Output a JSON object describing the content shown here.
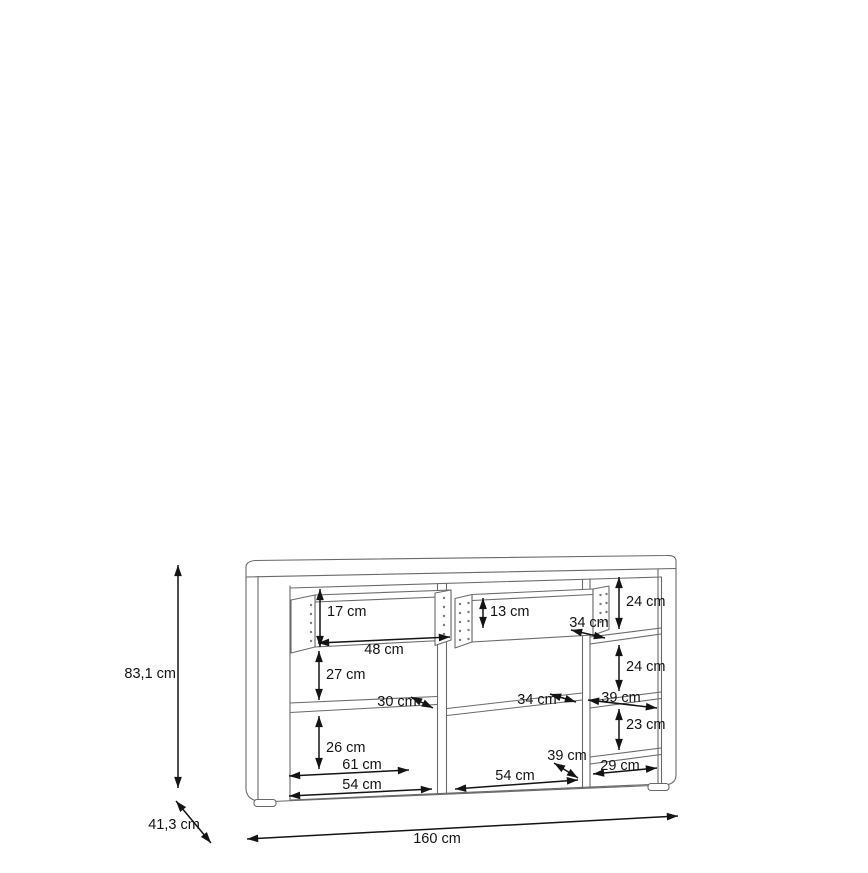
{
  "diagram": {
    "kind": "furniture-dimension-drawing",
    "item": "sideboard with two pulled-out drawers, three columns and shelves",
    "accent_color": "#141414",
    "line_color": "#6a6a6a",
    "dims": {
      "height": "83,1 cm",
      "depth": "41,3 cm",
      "width": "160 cm",
      "drawer_left_height": "17 cm",
      "drawer_left_width": "48 cm",
      "drawer_right_height": "13 cm",
      "drawer_right_width": "34 cm",
      "right_top_height": "24 cm",
      "left_upper_height": "27 cm",
      "left_shelf_depth": "30 cm",
      "left_lower_height": "26 cm",
      "left_shelf_width": "61 cm",
      "left_opening_width": "54 cm",
      "mid_shelf_depth": "34 cm",
      "mid_bottom_depth": "39 cm",
      "mid_opening_width": "54 cm",
      "right_mid_height": "24 cm",
      "right_shelf_depth": "39 cm",
      "right_lower_height": "23 cm",
      "right_opening_width": "29 cm"
    }
  }
}
